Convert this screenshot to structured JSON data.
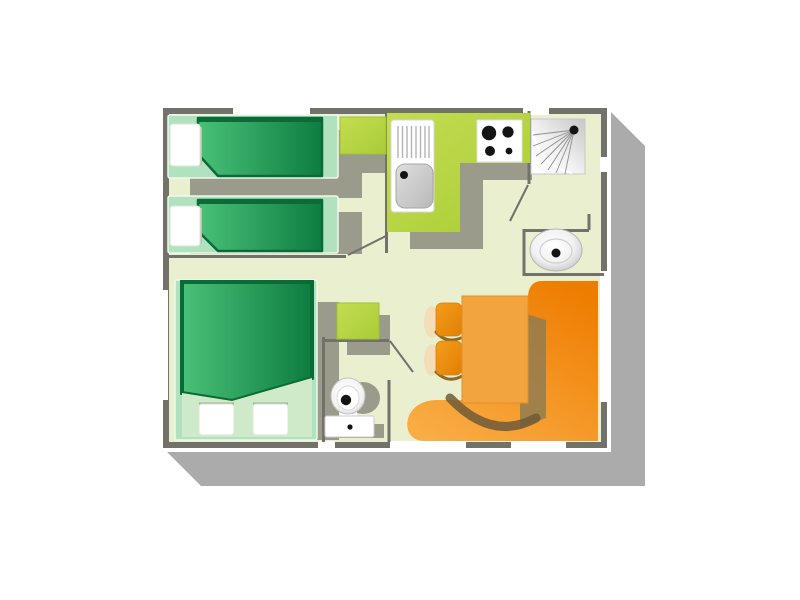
{
  "plan": {
    "type": "floor-plan",
    "style": "top-down illustrated mobile-home / chalet layout with drop shadow",
    "rooms": [
      {
        "name": "twin-bedroom",
        "position": "top-left",
        "furniture": [
          "single-bed",
          "single-bed",
          "wardrobe"
        ]
      },
      {
        "name": "kitchen",
        "position": "top-middle",
        "furniture": [
          "l-shaped-counter",
          "sink-unit-with-drainer",
          "hob-4-burners"
        ]
      },
      {
        "name": "bathroom",
        "position": "top-right",
        "furniture": [
          "shower-cabin",
          "washbasin"
        ]
      },
      {
        "name": "master-bedroom",
        "position": "bottom-left",
        "furniture": [
          "double-bed-2-pillows"
        ]
      },
      {
        "name": "wc",
        "position": "bottom-middle",
        "furniture": [
          "toilet",
          "storage-cabinet"
        ]
      },
      {
        "name": "living-dining",
        "position": "bottom-right",
        "furniture": [
          "corner-bench-sofa",
          "dining-table",
          "chair",
          "chair"
        ]
      }
    ],
    "doors": [
      "twin-bedroom-door",
      "bathroom-door",
      "wc-door"
    ],
    "windows_count": 7
  },
  "colors": {
    "background": "#ffffff",
    "plan_shadow": "#ababab",
    "floor": "#e9efcf",
    "wall": "#72726b",
    "window_white": "#ffffff",
    "furniture_shadow": "#9b9b8c",
    "lime_light": "#c4dd52",
    "lime_dark": "#a9cc36",
    "bed_frame": "#b0e2bf",
    "bed_green_light": "#49c178",
    "bed_green_dark": "#0e7c40",
    "bed_green_edge": "#0a6b36",
    "sheet": "#cfeac9",
    "pillow_white": "#ffffff",
    "appliance_white": "#ffffff",
    "steel_light": "#dedede",
    "steel_dark": "#b9b9b9",
    "shower_shade": "#c6c6c6",
    "shower_mid": "#f2f2f2",
    "basin_rim": "#c9c9c9",
    "bowl_rim": "#cfcfcf",
    "ink_black": "#141414",
    "bench_orange": "#ee7c00",
    "bench_orange_light": "#f9ad45",
    "table_orange": "#f2a43f",
    "chair_orange_light": "#f59d1c",
    "chair_orange_dark": "#e07f04",
    "table_cast_shadow": "#8c7a52",
    "swoosh_brown": "#6f5b38",
    "chair_arc_brown": "#8a6a28",
    "peach_glow": "#f6ddba"
  }
}
